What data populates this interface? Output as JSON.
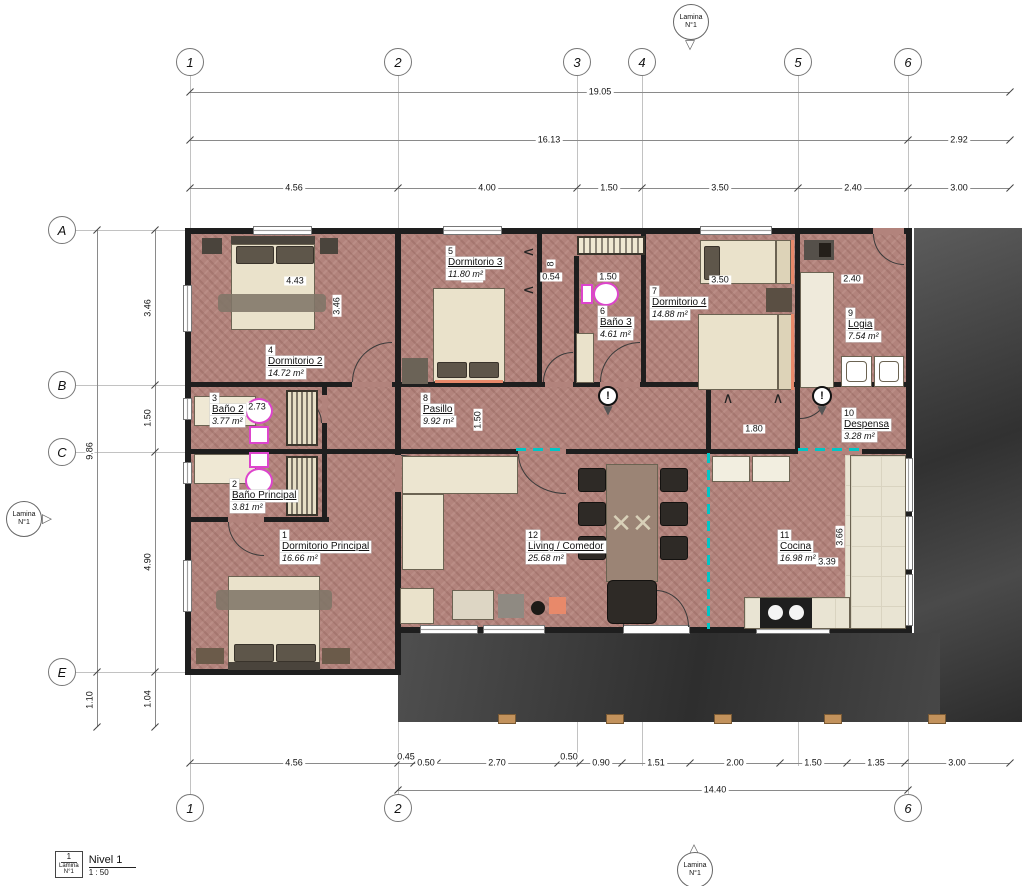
{
  "markers": {
    "line1": "Lamina",
    "line2": "N°1"
  },
  "grid": {
    "top": [
      "1",
      "2",
      "3",
      "4",
      "5",
      "6"
    ],
    "bottom": [
      "1",
      "2",
      "6"
    ],
    "left": [
      "A",
      "B",
      "C",
      "E"
    ]
  },
  "dims": {
    "top1": "19.05",
    "top2": [
      "16.13",
      "2.92"
    ],
    "top3": [
      "4.56",
      "4.00",
      "1.50",
      "3.50",
      "2.40",
      "3.00"
    ],
    "left_outer": [
      "9.86",
      "1.10"
    ],
    "left_inner": [
      "3.46",
      "1.50",
      "4.90",
      "1.04"
    ],
    "bottom1": [
      "4.56",
      "0.45",
      "0.50",
      "2.70",
      "0.50",
      "0.90",
      "1.51",
      "2.00",
      "1.50",
      "1.35",
      "3.00"
    ],
    "bottom2": "14.40",
    "interior": {
      "dorm2_w": "4.43",
      "dorm2_h": "3.46",
      "dorm3_w": "3.34",
      "closet_v": "8",
      "closet": "0.54",
      "bano3_w": "1.50",
      "dorm4_w": "3.50",
      "logia_w": "2.40",
      "bano2_w": "2.73",
      "pasillo_h": "1.50",
      "hall_w": "1.80",
      "cocina_w": "3.39",
      "cocina_h": "3.66"
    }
  },
  "rooms": [
    {
      "number": "1",
      "name": "Dormitorio Principal",
      "area": "16.66 m²"
    },
    {
      "number": "2",
      "name": "Baño Principal",
      "area": "3.81 m²"
    },
    {
      "number": "3",
      "name": "Baño 2",
      "area": "3.77 m²"
    },
    {
      "number": "4",
      "name": "Dormitorio 2",
      "area": "14.72 m²"
    },
    {
      "number": "5",
      "name": "Dormitorio 3",
      "area": "11.80 m²"
    },
    {
      "number": "6",
      "name": "Baño 3",
      "area": "4.61 m²"
    },
    {
      "number": "7",
      "name": "Dormitorio 4",
      "area": "14.88 m²"
    },
    {
      "number": "8",
      "name": "Pasillo",
      "area": "9.92 m²"
    },
    {
      "number": "9",
      "name": "Logia",
      "area": "7.54 m²"
    },
    {
      "number": "10",
      "name": "Despensa",
      "area": "3.28 m²"
    },
    {
      "number": "11",
      "name": "Cocina",
      "area": "16.98 m²"
    },
    {
      "number": "12",
      "name": "Living / Comedor",
      "area": "25.68 m²"
    }
  ],
  "titleblock": {
    "number": "1",
    "sheet_line1": "Lamina",
    "sheet_line2": "N°1",
    "title": "Nivel 1",
    "scale": "1 : 50"
  }
}
